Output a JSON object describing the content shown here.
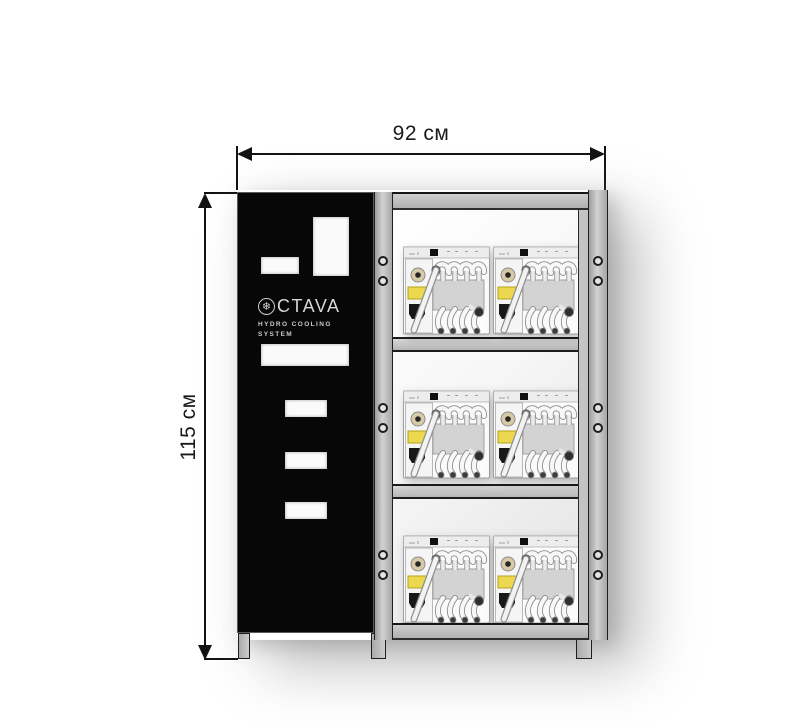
{
  "diagram": {
    "dimensions": {
      "width": {
        "label": "92 см",
        "value": 92,
        "unit": "см"
      },
      "height": {
        "label": "115 см",
        "value": 115,
        "unit": "см"
      }
    },
    "branding": {
      "name": "OCTAVA",
      "logo_text": "CTAVA",
      "logo_icon": "snowflake-icon",
      "subtitle_line1": "HYDRO  COOLING",
      "subtitle_line2": "SYSTEM"
    },
    "colors": {
      "panel_black": "#070707",
      "frame_gray": "#c2c2c2",
      "warning_label_yellow": "#ecd84e",
      "dimension_line": "#131313"
    },
    "rack": {
      "rows": 3,
      "columns": 2,
      "unit_count": 6
    }
  },
  "rack_layout": {
    "machines": [
      {
        "x": 29,
        "y": 53
      },
      {
        "x": 119,
        "y": 53
      },
      {
        "x": 29,
        "y": 197
      },
      {
        "x": 119,
        "y": 197
      },
      {
        "x": 29,
        "y": 342
      },
      {
        "x": 119,
        "y": 342
      }
    ],
    "bolt_xs": [
      4,
      219
    ],
    "bolt_ys": [
      66,
      86,
      213,
      233,
      360,
      380
    ]
  }
}
